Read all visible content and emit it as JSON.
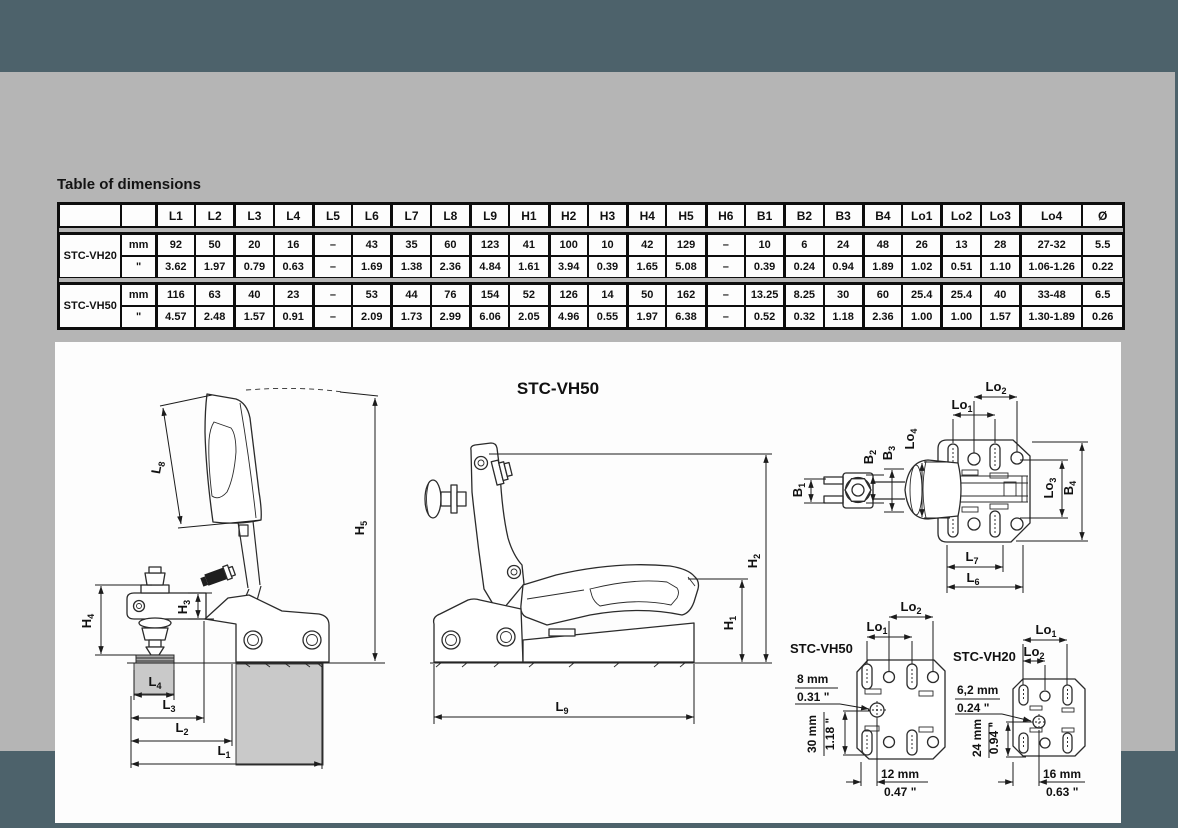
{
  "colors": {
    "frame": "#4d626b",
    "page_bg": "#b5b5b5",
    "panel_bg": "#fdfdfd",
    "line": "#2b2b2b"
  },
  "heading": "Table of dimensions",
  "table": {
    "columns": [
      "L1",
      "L2",
      "L3",
      "L4",
      "L5",
      "L6",
      "L7",
      "L8",
      "L9",
      "H1",
      "H2",
      "H3",
      "H4",
      "H5",
      "H6",
      "B1",
      "B2",
      "B3",
      "B4",
      "Lo1",
      "Lo2",
      "Lo3",
      "Lo4",
      "Ø"
    ],
    "models": [
      {
        "name": "STC-VH20",
        "unit_mm": "mm",
        "unit_in": "\"",
        "mm": [
          "92",
          "50",
          "20",
          "16",
          "–",
          "43",
          "35",
          "60",
          "123",
          "41",
          "100",
          "10",
          "42",
          "129",
          "–",
          "10",
          "6",
          "24",
          "48",
          "26",
          "13",
          "28",
          "27-32",
          "5.5"
        ],
        "in": [
          "3.62",
          "1.97",
          "0.79",
          "0.63",
          "–",
          "1.69",
          "1.38",
          "2.36",
          "4.84",
          "1.61",
          "3.94",
          "0.39",
          "1.65",
          "5.08",
          "–",
          "0.39",
          "0.24",
          "0.94",
          "1.89",
          "1.02",
          "0.51",
          "1.10",
          "1.06-1.26",
          "0.22"
        ]
      },
      {
        "name": "STC-VH50",
        "unit_mm": "mm",
        "unit_in": "\"",
        "mm": [
          "116",
          "63",
          "40",
          "23",
          "–",
          "53",
          "44",
          "76",
          "154",
          "52",
          "126",
          "14",
          "50",
          "162",
          "–",
          "13.25",
          "8.25",
          "30",
          "60",
          "25.4",
          "25.4",
          "40",
          "33-48",
          "6.5"
        ],
        "in": [
          "4.57",
          "2.48",
          "1.57",
          "0.91",
          "–",
          "2.09",
          "1.73",
          "2.99",
          "6.06",
          "2.05",
          "4.96",
          "0.55",
          "1.97",
          "6.38",
          "–",
          "0.52",
          "0.32",
          "1.18",
          "2.36",
          "1.00",
          "1.00",
          "1.57",
          "1.30-1.89",
          "0.26"
        ]
      }
    ]
  },
  "drawings": {
    "closed_view": {
      "labels": {
        "l8": "L8",
        "h5": "H5",
        "h4": "H4",
        "h3": "H3",
        "l4": "L4",
        "l3": "L3",
        "l2": "L2",
        "l1": "L1"
      }
    },
    "open_view": {
      "title": "STC-VH50",
      "labels": {
        "h2": "H2",
        "h1": "H1",
        "l9": "L9"
      }
    },
    "top_view": {
      "labels": {
        "lo1": "Lo1",
        "lo2": "Lo2",
        "lo3": "Lo3",
        "lo4": "Lo4",
        "b1": "B1",
        "b2": "B2",
        "b3": "B3",
        "b4": "B4",
        "l7": "L7",
        "l6": "L6"
      }
    },
    "pattern_vh50": {
      "title": "STC-VH50",
      "labels": {
        "lo1": "Lo1",
        "lo2": "Lo2"
      },
      "hole_mm": "8 mm",
      "hole_in": "0.31 \"",
      "v_mm": "30 mm",
      "v_in": "1.18 \"",
      "h_mm": "12 mm",
      "h_in": "0.47 \""
    },
    "pattern_vh20": {
      "title": "STC-VH20",
      "labels": {
        "lo1": "Lo1",
        "lo2": "Lo2"
      },
      "hole_mm": "6,2 mm",
      "hole_in": "0.24 \"",
      "v_mm": "24 mm",
      "v_in": "0.94 \"",
      "h_mm": "16 mm",
      "h_in": "0.63 \""
    }
  }
}
